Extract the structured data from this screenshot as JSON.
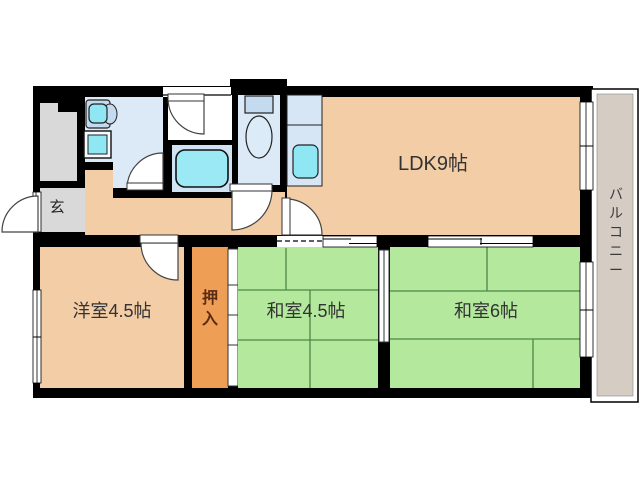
{
  "page": {
    "background": "#ffffff",
    "type": "apartment-floor-plan"
  },
  "rooms": [
    {
      "id": "ldk",
      "label": "LDK9帖"
    },
    {
      "id": "genkan",
      "label": "玄"
    },
    {
      "id": "youshitsu",
      "label": "洋室4.5帖"
    },
    {
      "id": "oshiire",
      "label": "押入"
    },
    {
      "id": "washitsu45",
      "label": "和室4.5帖"
    },
    {
      "id": "washitsu6",
      "label": "和室6帖"
    },
    {
      "id": "balcony",
      "label": "バルコニー"
    }
  ],
  "colors": {
    "wall": "#000000",
    "wood_room": "#f3cda6",
    "tatami": "#b3e89d",
    "tatami_line": "#4c8746",
    "closet": "#ef9f55",
    "entry_gray": "#d9d9d9",
    "water_room": "#dceaf8",
    "bath_room": "#cfe3f4",
    "fixture_cyan": "#8ee7f3",
    "balcony_floor": "#d5cdc4",
    "label_text": "#333333",
    "closet_text": "#5c2b16"
  },
  "shapes": [
    {
      "n": "unit-walls",
      "t": "rect",
      "x": 33,
      "y": 86,
      "w": 560,
      "h": 312,
      "f": "#000000"
    },
    {
      "n": "toilet-top-wall-bump",
      "t": "rect",
      "x": 230,
      "y": 79,
      "w": 57,
      "h": 12,
      "f": "#000000"
    },
    {
      "n": "balcony-outer-border",
      "t": "rect",
      "x": 591,
      "y": 89,
      "w": 47,
      "h": 313,
      "f": "#ffffff",
      "s": "#000000",
      "sw": 1.5
    },
    {
      "n": "balcony-floor",
      "t": "rect",
      "x": 597,
      "y": 94,
      "w": 36,
      "h": 302,
      "f": "#d5cdc4",
      "s": "#888888",
      "sw": 0.6
    },
    {
      "n": "stairwell-area",
      "t": "rect",
      "x": 40,
      "y": 103,
      "w": 37,
      "h": 78,
      "f": "#d9d9d9"
    },
    {
      "n": "stairwell-step-notch",
      "t": "rect",
      "x": 58,
      "y": 103,
      "w": 19,
      "h": 9,
      "f": "#000000"
    },
    {
      "n": "genkan-floor",
      "t": "rect",
      "x": 40,
      "y": 188,
      "w": 45,
      "h": 44,
      "f": "#d9d9d9"
    },
    {
      "n": "washroom-floor",
      "t": "rect",
      "x": 85,
      "y": 97,
      "w": 78,
      "h": 91,
      "f": "#dceaf8"
    },
    {
      "n": "washroom-corner-wall",
      "t": "rect",
      "x": 85,
      "y": 162,
      "w": 28,
      "h": 8,
      "f": "#000000"
    },
    {
      "n": "hallway-floor-left",
      "t": "rect",
      "x": 85,
      "y": 170,
      "w": 28,
      "h": 30,
      "f": "#f3cda6"
    },
    {
      "n": "hallway-floor",
      "t": "rect",
      "x": 85,
      "y": 198,
      "w": 200,
      "h": 37,
      "f": "#f3cda6"
    },
    {
      "n": "hallway-floor-toilet-front",
      "t": "rect",
      "x": 238,
      "y": 192,
      "w": 47,
      "h": 8,
      "f": "#f3cda6"
    },
    {
      "n": "bath-entry-floor",
      "t": "rect",
      "x": 168,
      "y": 95,
      "w": 64,
      "h": 45,
      "f": "#ffffff"
    },
    {
      "n": "bathroom-floor",
      "t": "rect",
      "x": 172,
      "y": 145,
      "w": 60,
      "h": 47,
      "f": "#cfe3f4"
    },
    {
      "n": "toilet-floor",
      "t": "rect",
      "x": 238,
      "y": 95,
      "w": 42,
      "h": 90,
      "f": "#dceaf8"
    },
    {
      "n": "ldk-floor",
      "t": "rect",
      "x": 287,
      "y": 97,
      "w": 293,
      "h": 138,
      "f": "#f3cda6"
    },
    {
      "n": "youshitsu-floor",
      "t": "rect",
      "x": 40,
      "y": 247,
      "w": 144,
      "h": 141,
      "f": "#f3cda6"
    },
    {
      "n": "oshiire-floor",
      "t": "rect",
      "x": 192,
      "y": 247,
      "w": 36,
      "h": 141,
      "f": "#ef9f55"
    },
    {
      "n": "oshiire-fusuma",
      "t": "rect",
      "x": 228,
      "y": 249,
      "w": 10,
      "h": 137,
      "f": "#ffffff",
      "s": "#333333",
      "sw": 1
    },
    {
      "n": "oshiire-fusuma-tick",
      "t": "line",
      "x1": 228,
      "y1": 285,
      "x2": 238,
      "y2": 285,
      "s": "#333333",
      "sw": 1
    },
    {
      "n": "oshiire-fusuma-tick",
      "t": "line",
      "x1": 228,
      "y1": 315,
      "x2": 238,
      "y2": 315,
      "s": "#333333",
      "sw": 1
    },
    {
      "n": "oshiire-fusuma-tick",
      "t": "line",
      "x1": 228,
      "y1": 345,
      "x2": 238,
      "y2": 345,
      "s": "#333333",
      "sw": 1
    },
    {
      "n": "washitsu45-floor",
      "t": "rect",
      "x": 238,
      "y": 247,
      "w": 140,
      "h": 141,
      "f": "#b3e89d"
    },
    {
      "n": "washitsu6-floor",
      "t": "rect",
      "x": 390,
      "y": 247,
      "w": 190,
      "h": 141,
      "f": "#b3e89d"
    },
    {
      "n": "washitsu-divider-fusuma",
      "t": "rect",
      "x": 379,
      "y": 250,
      "w": 10,
      "h": 92,
      "f": "#ffffff",
      "s": "#333333",
      "sw": 1
    },
    {
      "n": "washitsu-divider-fusuma-line",
      "t": "line",
      "x1": 384,
      "y1": 250,
      "x2": 384,
      "y2": 342,
      "s": "#333333",
      "sw": 1
    },
    {
      "n": "tatami-line",
      "t": "line",
      "x1": 286,
      "y1": 248,
      "x2": 286,
      "y2": 290,
      "s": "#4c8746",
      "sw": 1.3
    },
    {
      "n": "tatami-line",
      "t": "line",
      "x1": 238,
      "y1": 290,
      "x2": 378,
      "y2": 290,
      "s": "#4c8746",
      "sw": 1.3
    },
    {
      "n": "tatami-line",
      "t": "line",
      "x1": 310,
      "y1": 290,
      "x2": 310,
      "y2": 388,
      "s": "#4c8746",
      "sw": 1.3
    },
    {
      "n": "tatami-line",
      "t": "line",
      "x1": 238,
      "y1": 340,
      "x2": 378,
      "y2": 340,
      "s": "#4c8746",
      "sw": 1.3
    },
    {
      "n": "tatami-line",
      "t": "line",
      "x1": 487,
      "y1": 247,
      "x2": 487,
      "y2": 291,
      "s": "#4c8746",
      "sw": 1.3
    },
    {
      "n": "tatami-line",
      "t": "line",
      "x1": 390,
      "y1": 291,
      "x2": 580,
      "y2": 291,
      "s": "#4c8746",
      "sw": 1.3
    },
    {
      "n": "tatami-line",
      "t": "line",
      "x1": 390,
      "y1": 339,
      "x2": 580,
      "y2": 339,
      "s": "#4c8746",
      "sw": 1.3
    },
    {
      "n": "tatami-line",
      "t": "line",
      "x1": 533,
      "y1": 339,
      "x2": 533,
      "y2": 388,
      "s": "#4c8746",
      "sw": 1.3
    },
    {
      "n": "youshitsu-window",
      "t": "rect",
      "x": 33,
      "y": 290,
      "w": 8,
      "h": 93,
      "f": "#ffffff",
      "s": "#000000",
      "sw": 0.8
    },
    {
      "n": "youshitsu-window-line",
      "t": "line",
      "x1": 37,
      "y1": 290,
      "x2": 37,
      "y2": 383,
      "s": "#000000",
      "sw": 0.8
    },
    {
      "n": "youshitsu-window-tick",
      "t": "line",
      "x1": 33,
      "y1": 337,
      "x2": 41,
      "y2": 337,
      "s": "#000000",
      "sw": 1
    },
    {
      "n": "ldk-balcony-window",
      "t": "rect",
      "x": 580,
      "y": 102,
      "w": 13,
      "h": 88,
      "f": "#ffffff",
      "s": "#000000",
      "sw": 0.8
    },
    {
      "n": "ldk-balcony-window-line",
      "t": "line",
      "x1": 586,
      "y1": 102,
      "x2": 586,
      "y2": 190,
      "s": "#000000",
      "sw": 0.8
    },
    {
      "n": "ldk-balcony-window-tick",
      "t": "line",
      "x1": 580,
      "y1": 146,
      "x2": 593,
      "y2": 146,
      "s": "#000000",
      "sw": 1
    },
    {
      "n": "washitsu6-balcony-window",
      "t": "rect",
      "x": 580,
      "y": 262,
      "w": 13,
      "h": 95,
      "f": "#ffffff",
      "s": "#000000",
      "sw": 0.8
    },
    {
      "n": "washitsu6-balcony-window-line",
      "t": "line",
      "x1": 586,
      "y1": 262,
      "x2": 586,
      "y2": 357,
      "s": "#000000",
      "sw": 0.8
    },
    {
      "n": "washitsu6-balcony-window-tick",
      "t": "line",
      "x1": 580,
      "y1": 310,
      "x2": 593,
      "y2": 310,
      "s": "#000000",
      "sw": 1
    },
    {
      "n": "bath-window",
      "t": "rect",
      "x": 163,
      "y": 87,
      "w": 68,
      "h": 10,
      "f": "#ffffff"
    },
    {
      "n": "bath-window-line",
      "t": "line",
      "x1": 163,
      "y1": 95,
      "x2": 231,
      "y2": 95,
      "s": "#000000",
      "sw": 1.2
    },
    {
      "n": "entrance-opening",
      "t": "rect",
      "x": 33,
      "y": 192,
      "w": 8,
      "h": 40,
      "f": "#ffffff",
      "s": "#000000",
      "sw": 0.8
    },
    {
      "n": "entrance-opening-line",
      "t": "line",
      "x1": 36,
      "y1": 192,
      "x2": 36,
      "y2": 232,
      "s": "#000000",
      "sw": 0.8
    },
    {
      "n": "entrance-door-swing",
      "t": "path",
      "d": "M 38 232 L 38 196 A 36 36 0 0 0 2 232 Z",
      "f": "#ffffff",
      "s": "#444444",
      "sw": 1.2
    },
    {
      "n": "ldk-hall-open-boundary",
      "t": "rect",
      "x": 277,
      "y": 236,
      "w": 46,
      "h": 11,
      "f": "#ffffff"
    },
    {
      "n": "ldk-hall-open-dashes",
      "t": "line",
      "x1": 277,
      "y1": 241,
      "x2": 323,
      "y2": 241,
      "s": "#000000",
      "sw": 1.3,
      "dash": "5,3"
    },
    {
      "n": "ldk-washitsu45-sliding-door",
      "t": "rect",
      "x": 323,
      "y": 236,
      "w": 54,
      "h": 11,
      "f": "#ffffff",
      "s": "#000000",
      "sw": 0.8
    },
    {
      "n": "ldk-washitsu45-sliding-door-line",
      "t": "line",
      "x1": 323,
      "y1": 239,
      "x2": 351,
      "y2": 239,
      "s": "#000000",
      "sw": 1
    },
    {
      "n": "ldk-washitsu45-sliding-door-line",
      "t": "line",
      "x1": 349,
      "y1": 243.5,
      "x2": 377,
      "y2": 243.5,
      "s": "#000000",
      "sw": 1
    },
    {
      "n": "ldk-washitsu6-sliding-door",
      "t": "rect",
      "x": 428,
      "y": 236,
      "w": 105,
      "h": 11,
      "f": "#ffffff",
      "s": "#000000",
      "sw": 0.8
    },
    {
      "n": "ldk-washitsu6-sliding-door-line",
      "t": "line",
      "x1": 428,
      "y1": 239,
      "x2": 482,
      "y2": 239,
      "s": "#000000",
      "sw": 1
    },
    {
      "n": "ldk-washitsu6-sliding-door-line",
      "t": "line",
      "x1": 480,
      "y1": 243.5,
      "x2": 533,
      "y2": 243.5,
      "s": "#000000",
      "sw": 1
    },
    {
      "n": "ldk-washitsu6-sliding-door-tick",
      "t": "line",
      "x1": 481,
      "y1": 238,
      "x2": 481,
      "y2": 245,
      "s": "#000000",
      "sw": 1
    },
    {
      "n": "youshitsu-door-swing",
      "t": "path",
      "d": "M 178 243 L 141 243 A 37 37 0 0 0 178 280 Z",
      "f": "#ffffff",
      "s": "#444444",
      "sw": 1.2
    },
    {
      "n": "youshitsu-door-leaf",
      "t": "rect",
      "x": 140,
      "y": 235,
      "w": 38,
      "h": 8,
      "f": "#ffffff",
      "s": "#333333",
      "sw": 1
    },
    {
      "n": "ldk-door-swing",
      "t": "path",
      "d": "M 286 235 L 286 199 A 36 36 0 0 1 322 235 Z",
      "f": "#ffffff",
      "s": "#444444",
      "sw": 1.2
    },
    {
      "n": "ldk-door-leaf",
      "t": "rect",
      "x": 282,
      "y": 198,
      "w": 8,
      "h": 37,
      "f": "#ffffff",
      "s": "#333333",
      "sw": 1
    },
    {
      "n": "toilet-door-swing",
      "t": "path",
      "d": "M 232 190 L 272 190 A 40 40 0 0 1 232 230 Z",
      "f": "#ffffff",
      "s": "#444444",
      "sw": 1.2
    },
    {
      "n": "toilet-door-leaf",
      "t": "rect",
      "x": 230,
      "y": 184,
      "w": 42,
      "h": 7,
      "f": "#ffffff",
      "s": "#333333",
      "sw": 1
    },
    {
      "n": "washroom-door-swing",
      "t": "path",
      "d": "M 163 189 L 127 189 A 36 36 0 0 1 163 153 Z",
      "f": "#ffffff",
      "s": "#444444",
      "sw": 1.2
    },
    {
      "n": "washroom-door-leaf",
      "t": "rect",
      "x": 127,
      "y": 183,
      "w": 36,
      "h": 7,
      "f": "#ffffff",
      "s": "#333333",
      "sw": 1
    },
    {
      "n": "bath-entry-door-swing",
      "t": "path",
      "d": "M 204 98 L 168 98 A 36 36 0 0 0 204 134 Z",
      "f": "#ffffff",
      "s": "#444444",
      "sw": 1.2
    },
    {
      "n": "bath-entry-door-leaf",
      "t": "rect",
      "x": 168,
      "y": 94,
      "w": 36,
      "h": 7,
      "f": "#ffffff",
      "s": "#333333",
      "sw": 1
    },
    {
      "n": "vanity-unit",
      "t": "rect",
      "x": 86,
      "y": 100,
      "w": 24,
      "h": 28,
      "rx": 3,
      "f": "#c3daef",
      "s": "#222222",
      "sw": 1.2
    },
    {
      "n": "vanity-side-bump",
      "t": "ellipse",
      "cx": 110,
      "cy": 114,
      "rx": 7,
      "ry": 10,
      "f": "#c3daef",
      "s": "#222222",
      "sw": 1
    },
    {
      "n": "vanity-basin",
      "t": "rect",
      "x": 89,
      "y": 104,
      "w": 18,
      "h": 19,
      "rx": 5,
      "f": "#8ee7f3",
      "s": "#222222",
      "sw": 1.2
    },
    {
      "n": "washer-pan-outer",
      "t": "rect",
      "x": 84,
      "y": 131,
      "w": 27,
      "h": 27,
      "f": "#f4fafd",
      "s": "#111111",
      "sw": 1.4
    },
    {
      "n": "washer-pan-inner",
      "t": "rect",
      "x": 88,
      "y": 135,
      "w": 19,
      "h": 19,
      "f": "#8ee7f3",
      "s": "#222222",
      "sw": 1
    },
    {
      "n": "bathtub",
      "t": "rect",
      "x": 176,
      "y": 150,
      "w": 52,
      "h": 37,
      "rx": 9,
      "f": "#9be9f4",
      "s": "#111111",
      "sw": 1.6
    },
    {
      "n": "toilet-tank",
      "t": "rect",
      "x": 245,
      "y": 96,
      "w": 28,
      "h": 17,
      "f": "#c3daef",
      "s": "#222222",
      "sw": 1.2
    },
    {
      "n": "toilet-bowl",
      "t": "ellipse",
      "cx": 259,
      "cy": 137,
      "rx": 13,
      "ry": 21,
      "f": "#dcebf8",
      "s": "#222222",
      "sw": 1.2
    },
    {
      "n": "kitchen-counter",
      "t": "rect",
      "x": 287,
      "y": 95,
      "w": 35,
      "h": 91,
      "f": "#d7e6f4",
      "s": "#222222",
      "sw": 1
    },
    {
      "n": "kitchen-counter-divider",
      "t": "line",
      "x1": 287,
      "y1": 125,
      "x2": 322,
      "y2": 125,
      "s": "#222222",
      "sw": 1
    },
    {
      "n": "kitchen-sink",
      "t": "rect",
      "x": 293,
      "y": 145,
      "w": 25,
      "h": 33,
      "rx": 6,
      "f": "#8ee7f3",
      "s": "#222222",
      "sw": 1.2
    },
    {
      "n": "ldk-label",
      "t": "text",
      "x": 433,
      "y": 170,
      "bind": "rooms.0.label",
      "size": 20,
      "color": "#333333"
    },
    {
      "n": "genkan-label",
      "t": "text",
      "x": 57,
      "y": 212,
      "bind": "rooms.1.label",
      "size": 15,
      "color": "#222222"
    },
    {
      "n": "youshitsu-label",
      "t": "text",
      "x": 112,
      "y": 317,
      "bind": "rooms.2.label",
      "size": 18,
      "color": "#333333"
    },
    {
      "n": "oshiire-label",
      "t": "text",
      "x": 210,
      "y": 303,
      "bind": "rooms.3.label",
      "size": 16,
      "color": "#5c2b16",
      "weight": "bold",
      "vertical": true,
      "dy": 21
    },
    {
      "n": "washitsu45-label",
      "t": "text",
      "x": 306,
      "y": 317,
      "bind": "rooms.4.label",
      "size": 18,
      "color": "#333333"
    },
    {
      "n": "washitsu6-label",
      "t": "text",
      "x": 486,
      "y": 317,
      "bind": "rooms.5.label",
      "size": 18,
      "color": "#333333"
    },
    {
      "n": "balcony-label",
      "t": "text",
      "x": 616,
      "y": 199,
      "bind": "rooms.6.label",
      "size": 14,
      "color": "#3a3a3a",
      "vertical": true,
      "dy": 19
    }
  ]
}
